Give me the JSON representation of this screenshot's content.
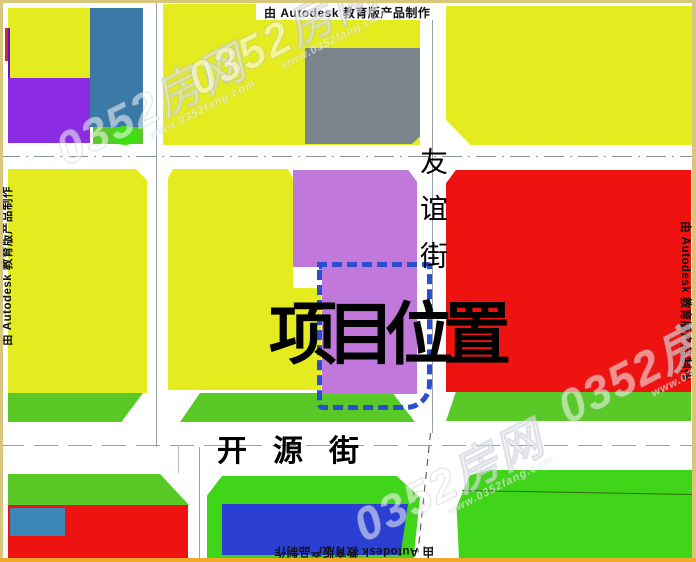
{
  "map": {
    "title": "项目位置平面示意图",
    "project": {
      "label": "项目位置"
    },
    "streets": {
      "vertical": "友谊街",
      "horizontal": "开源街"
    },
    "credits": {
      "autodesk": "由 Autodesk 教育版产品制作"
    },
    "watermark": {
      "brand": "0352房网",
      "url": "www.0352fang.com"
    },
    "palette": {
      "parcel_yellow": "#e4ec1f",
      "parcel_purple": "#8b2be2",
      "parcel_orchid_project": "#c078da",
      "parcel_steel_blue": "#3b79a6",
      "parcel_gray": "#7b848a",
      "parcel_red": "#ee1311",
      "greenery_strip": "#58c926",
      "greenery_bright": "#41d519",
      "greenery_ellipse": "#3ae10c",
      "parcel_royal_blue": "#2b3fd2",
      "parcel_small_blue": "#3c87b8",
      "project_dash_border": "#2a4ecf",
      "road_line": "#9aa2a4",
      "frame_tan": "#d8c77b",
      "frame_orange": "#f0a92b"
    }
  }
}
